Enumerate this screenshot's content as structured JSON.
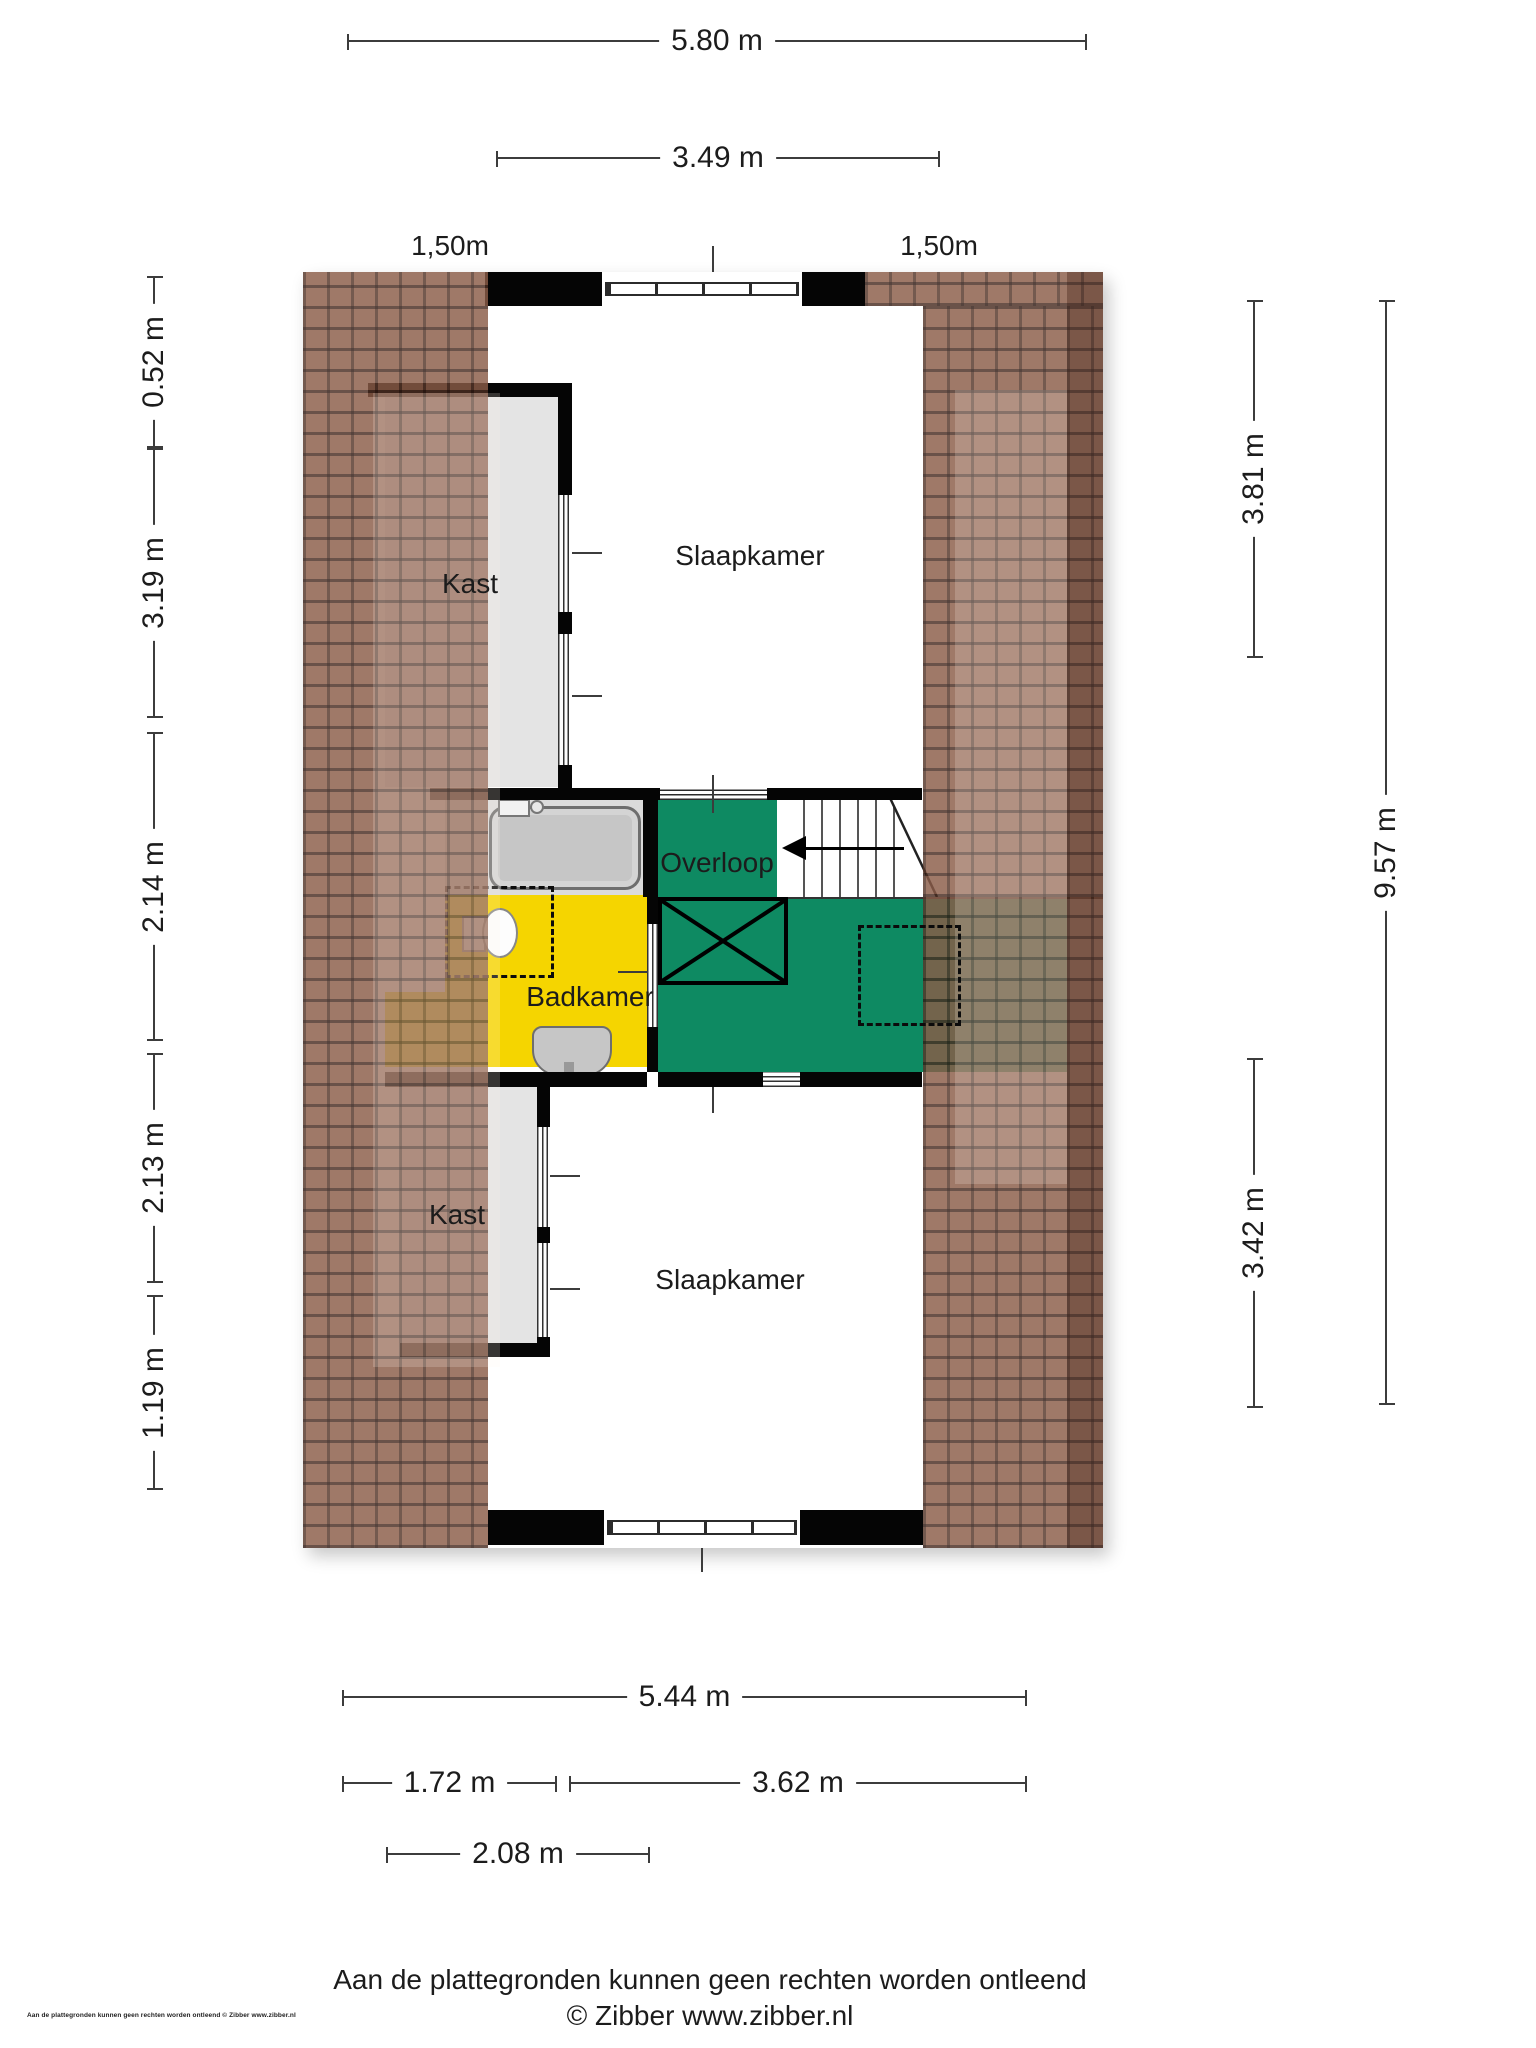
{
  "rooms": {
    "slaapkamer_top": "Slaapkamer",
    "kast_top": "Kast",
    "overloop": "Overloop",
    "badkamer": "Badkamer",
    "kast_bottom": "Kast",
    "slaapkamer_bottom": "Slaapkamer"
  },
  "dimensions": {
    "top": [
      {
        "label": "5.80 m"
      },
      {
        "label": "3.49 m"
      }
    ],
    "top_small": [
      {
        "label": "1,50m"
      },
      {
        "label": "1,50m"
      }
    ],
    "left": [
      {
        "label": "0.52 m"
      },
      {
        "label": "3.19 m"
      },
      {
        "label": "2.14 m"
      },
      {
        "label": "2.13 m"
      },
      {
        "label": "1.19 m"
      }
    ],
    "right": [
      {
        "label": "3.81 m"
      },
      {
        "label": "9.57 m"
      },
      {
        "label": "3.42 m"
      }
    ],
    "bottom": [
      {
        "label": "5.44 m"
      },
      {
        "label": "1.72 m"
      },
      {
        "label": "3.62 m"
      },
      {
        "label": "2.08 m"
      }
    ]
  },
  "footer": {
    "disclaimer": "Aan de plattegronden kunnen geen rechten worden ontleend",
    "credit": "© Zibber www.zibber.nl",
    "corner": "Aan de plattegronden kunnen geen rechten worden ontleend © Zibber www.zibber.nl"
  },
  "colors": {
    "green": "#0E8A62",
    "yellow": "#F5D500",
    "floor-gray": "#E4E4E4",
    "tub-gray": "#DBDBDB",
    "fixture-gray": "#C6C6C6",
    "tile": "#8A5C48",
    "wall": "#050505",
    "dim": "#3C3C3C",
    "text": "#1C1C1C"
  }
}
